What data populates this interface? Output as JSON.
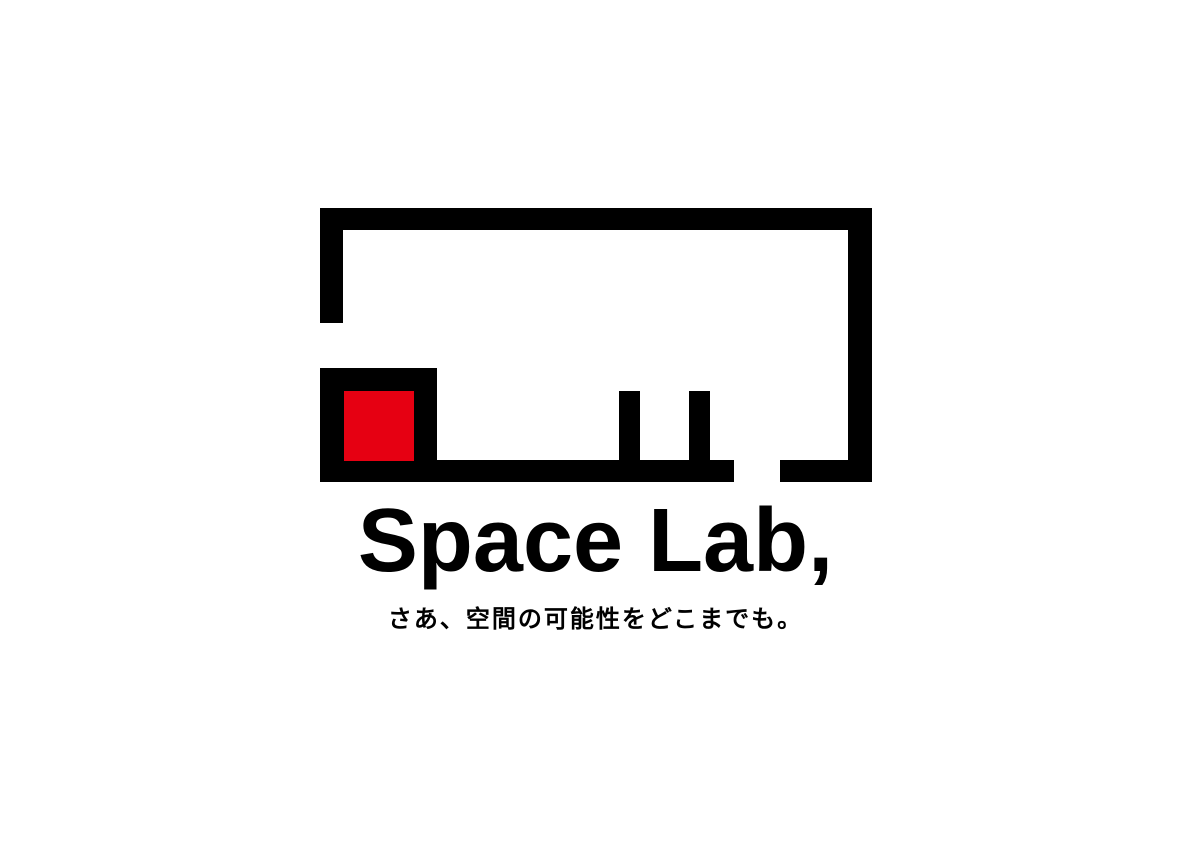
{
  "colors": {
    "ink": "#000000",
    "brand_red": "#e60012",
    "background": "#ffffff"
  },
  "logo": {
    "wordmark": "Space Lab,",
    "tagline": "さあ、空間の可能性をどこまでも。",
    "mark": {
      "description": "abstract room floor-plan outline with wall gaps, two pillars and a red square accent in the lower-left room block",
      "outline_color": "#000000",
      "accent_color": "#e60012"
    }
  }
}
